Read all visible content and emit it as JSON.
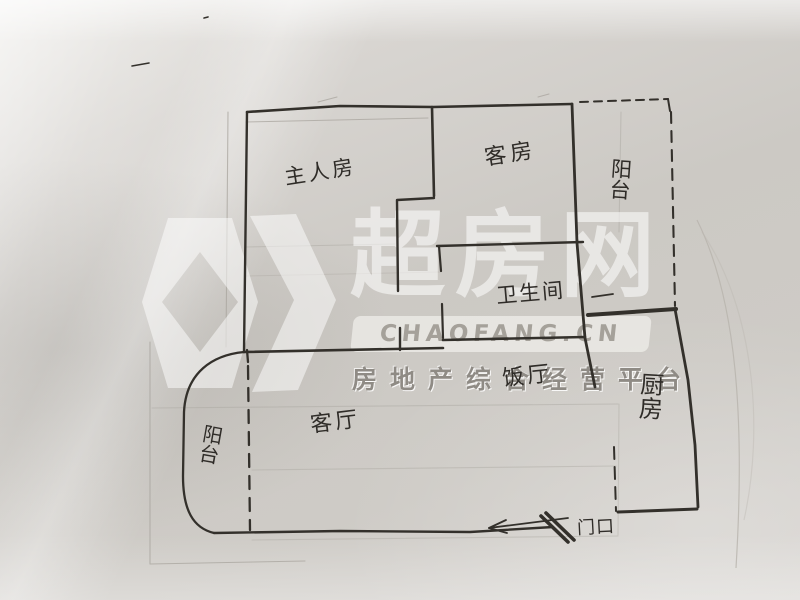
{
  "scene": {
    "kind": "photograph of a hand-drawn apartment floor plan sketched in ink on grey paper",
    "overlay": "real-estate site watermark"
  },
  "watermark": {
    "brand": "超房网",
    "domain": "CHAOFANG.CN",
    "slogan": "房地产综合经营平台",
    "logo_icon": "chaofang-diamond-logo"
  },
  "rooms": {
    "master_bedroom": "主人房",
    "guest_room": "客房",
    "balcony_top": "阳台",
    "bathroom": "卫生间",
    "dining_room": "饭厅",
    "kitchen": "厨房",
    "living_room": "客厅",
    "balcony_left": "阳台",
    "entrance": "门口"
  },
  "colors": {
    "paper": "#cecbc6",
    "ink": "#2f2c28",
    "pencil": "#a8a49d",
    "watermark_white": "#ffffff",
    "watermark_grey": "#8f8b85"
  }
}
